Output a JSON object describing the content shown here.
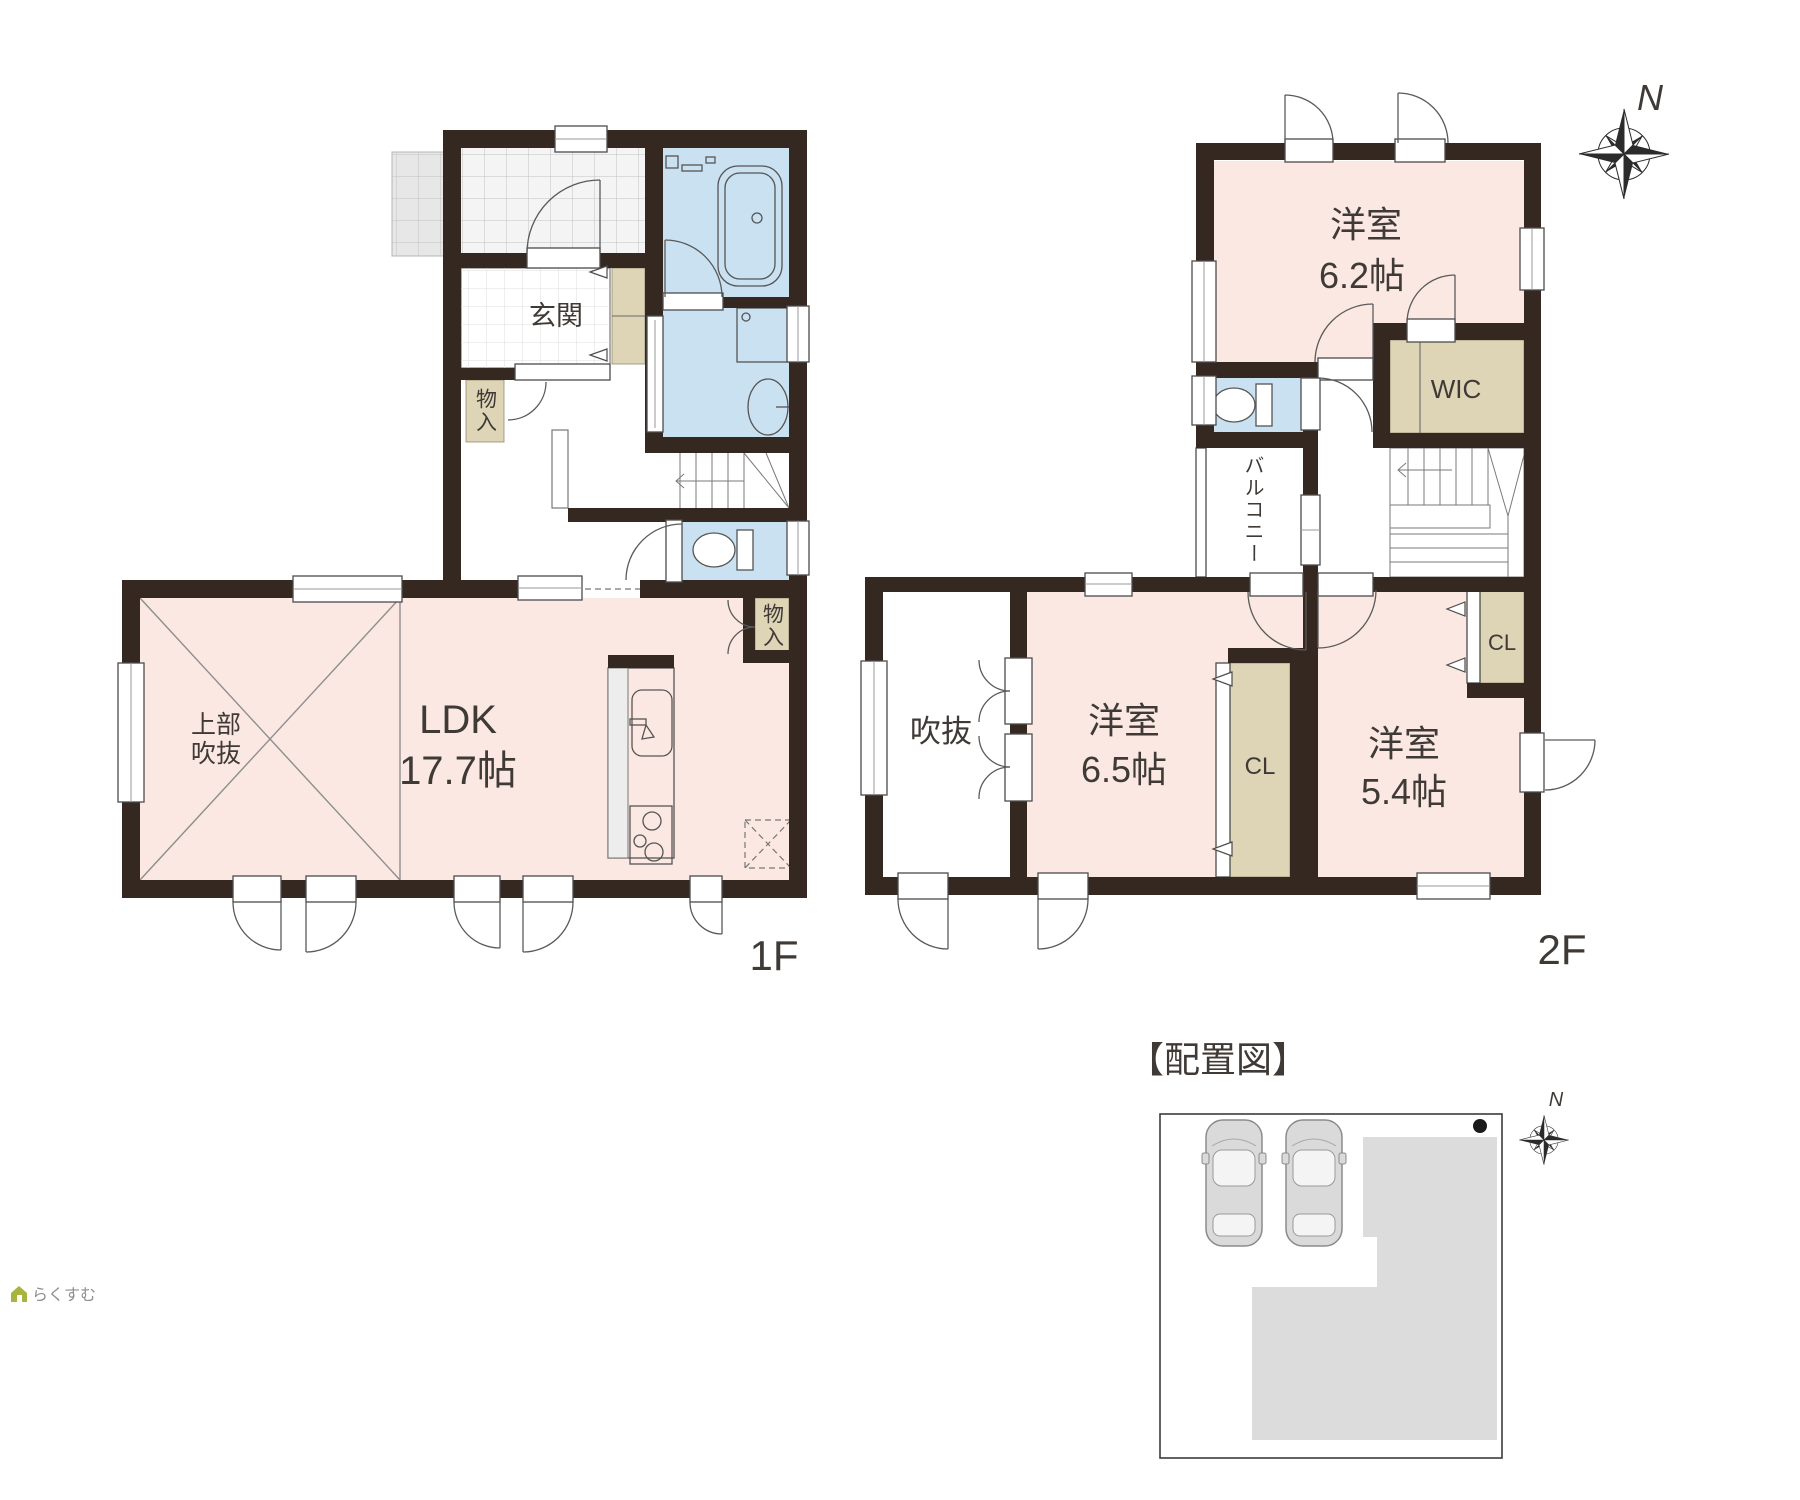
{
  "colors": {
    "wall": "#342821",
    "room_pink": "#fbe8e2",
    "wet_blue": "#c9e1f1",
    "closet_beige": "#ded4b6",
    "line": "#4c4c4c",
    "grid_line": "#c4c4c4",
    "site_gray": "#dcdcdc",
    "text": "#3f3a36",
    "logo_green": "#a9b43e",
    "logo_gray": "#8f8f8f"
  },
  "floor1": {
    "floor_label": "1F",
    "genkan": "玄関",
    "storage_entry": "物入",
    "ldk_name": "LDK",
    "ldk_size": "17.7帖",
    "void_label_line1": "上部",
    "void_label_line2": "吹抜",
    "storage_ldk": "物入"
  },
  "floor2": {
    "floor_label": "2F",
    "room62_name": "洋室",
    "room62_size": "6.2帖",
    "wic": "WIC",
    "balcony": "バルコニー",
    "void": "吹抜",
    "room65_name": "洋室",
    "room65_size": "6.5帖",
    "closet65": "CL",
    "room54_name": "洋室",
    "room54_size": "5.4帖",
    "closet54": "CL"
  },
  "site_plan": {
    "title": "【配置図】",
    "north": "N"
  },
  "compass": {
    "north": "N"
  },
  "logo": {
    "text": "らくすむ"
  },
  "icons": {
    "north_arrow": "compass-rose-star",
    "bathtub": "rounded-rect-tub-symbol",
    "toilet": "tank-and-bowl-symbol",
    "washbasin": "oval-basin-symbol",
    "stove": "three-burner-symbol",
    "car": "top-view-car-symbol",
    "house_logo": "small-house-glyph"
  }
}
